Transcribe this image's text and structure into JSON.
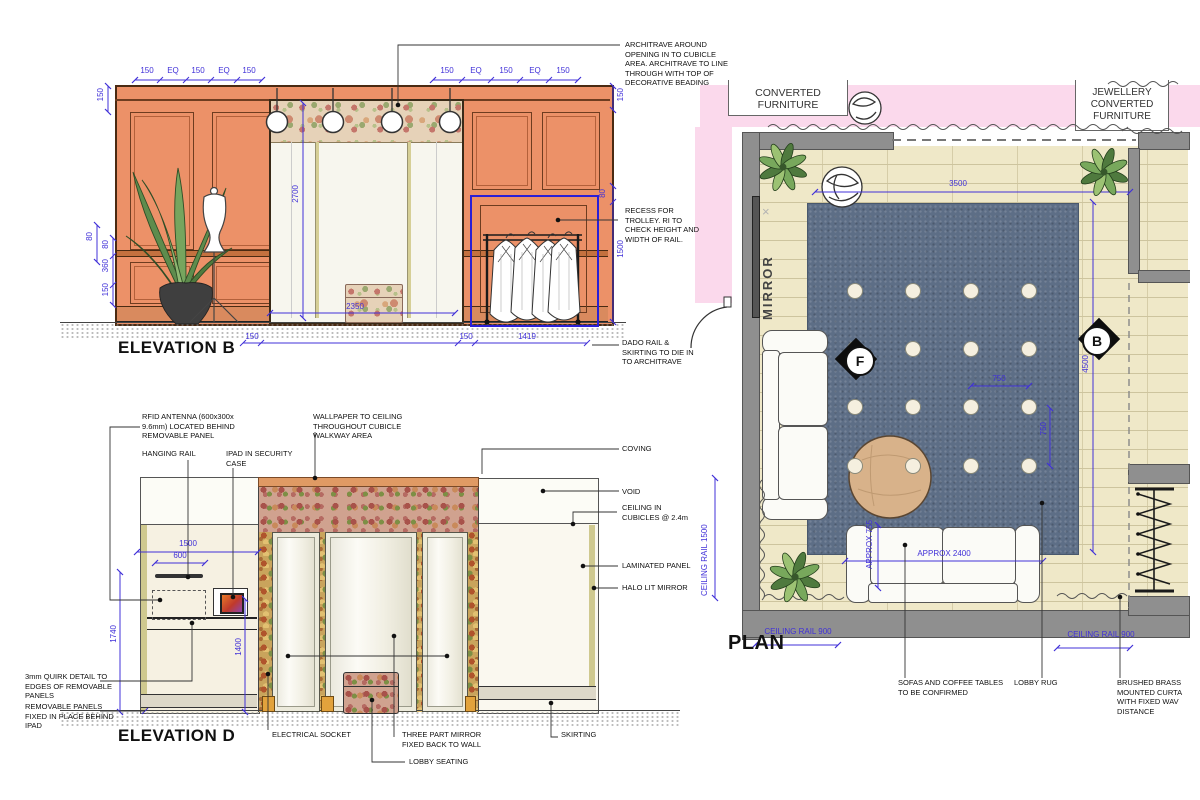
{
  "colors": {
    "dim_blue": "#4030d8",
    "wall_orange": "#ec9168",
    "recess_blue": "#2b1fd6",
    "pink_wall": "#fbd9ec",
    "rug_blue": "#5d6e86",
    "floor_cream": "#efe8c8",
    "wall_gray": "#8f8f8f"
  },
  "elevation_b": {
    "title": "ELEVATION B",
    "dims": {
      "top_left": [
        "150",
        "EQ",
        "150",
        "EQ",
        "150"
      ],
      "top_right": [
        "150",
        "EQ",
        "150",
        "EQ",
        "150"
      ],
      "side_top_left": "150",
      "side_top_right": "150",
      "left_outer": "80",
      "left_stack": [
        "80",
        "360",
        "150"
      ],
      "right_80": "80",
      "right_1500": "1500",
      "opening_height": "2700",
      "opening_width": "2350",
      "bottom_150_a": "150",
      "bottom_150_b": "150",
      "bottom_1419": "1419"
    },
    "notes": {
      "architrave": "ARCHITRAVE AROUND\nOPENING IN TO CUBICLE\nAREA. ARCHITRAVE TO LINE\nTHROUGH WITH TOP OF\nDECORATIVE BEADING",
      "recess": "RECESS FOR\nTROLLEY. RI TO\nCHECK HEIGHT AND\nWIDTH OF RAIL.",
      "dado": "DADO RAIL &\nSKIRTING TO DIE IN\nTO ARCHITRAVE"
    }
  },
  "elevation_d": {
    "title": "ELEVATION D",
    "dims": {
      "w1500": "1500",
      "w600": "600",
      "h1740": "1740",
      "h1400": "1400"
    },
    "notes": {
      "rfid": "RFID ANTENNA (600x300x\n9.6mm) LOCATED BEHIND\nREMOVABLE PANEL",
      "hanging_rail": "HANGING RAIL",
      "ipad": "IPAD IN SECURITY\nCASE",
      "wallpaper": "WALLPAPER TO CEILING\nTHROUGHOUT CUBICLE\nWALKWAY AREA",
      "coving": "COVING",
      "void": "VOID",
      "ceiling": "CEILING IN\nCUBICLES @ 2.4m",
      "laminated": "LAMINATED PANEL",
      "halo": "HALO LIT MIRROR",
      "quirk": "3mm QUIRK DETAIL TO\nEDGES OF REMOVABLE\nPANELS",
      "removable": "REMOVABLE PANELS\nFIXED IN PLACE BEHIND\nIPAD",
      "socket": "ELECTRICAL SOCKET",
      "three_part": "THREE PART MIRROR\nFIXED BACK TO WALL",
      "lobby_seating": "LOBBY SEATING",
      "skirting": "SKIRTING"
    }
  },
  "plan": {
    "title": "PLAN",
    "boxes": {
      "left": "CONVERTED\nFURNITURE",
      "right": "JEWELLERY\nCONVERTED\nFURNITURE"
    },
    "wall_label": "MIRROR",
    "markers": {
      "f": "F",
      "b": "B"
    },
    "dims": {
      "width": "3500",
      "depth": "4500",
      "spot_h": "750",
      "spot_v": "750",
      "sofa_length": "APPROX 2400",
      "sofa_depth": "APPROX 755",
      "rail_left": "CEILING RAIL 1500",
      "rail_bottom_left": "CEILING RAIL 900",
      "rail_bottom_right": "CEILING RAIL 900"
    },
    "notes": {
      "sofas": "SOFAS AND COFFEE TABLES\nTO BE CONFIRMED",
      "rug": "LOBBY RUG",
      "curtain": "BRUSHED BRASS\nMOUNTED CURTA\nWITH FIXED WAV\nDISTANCE"
    }
  }
}
